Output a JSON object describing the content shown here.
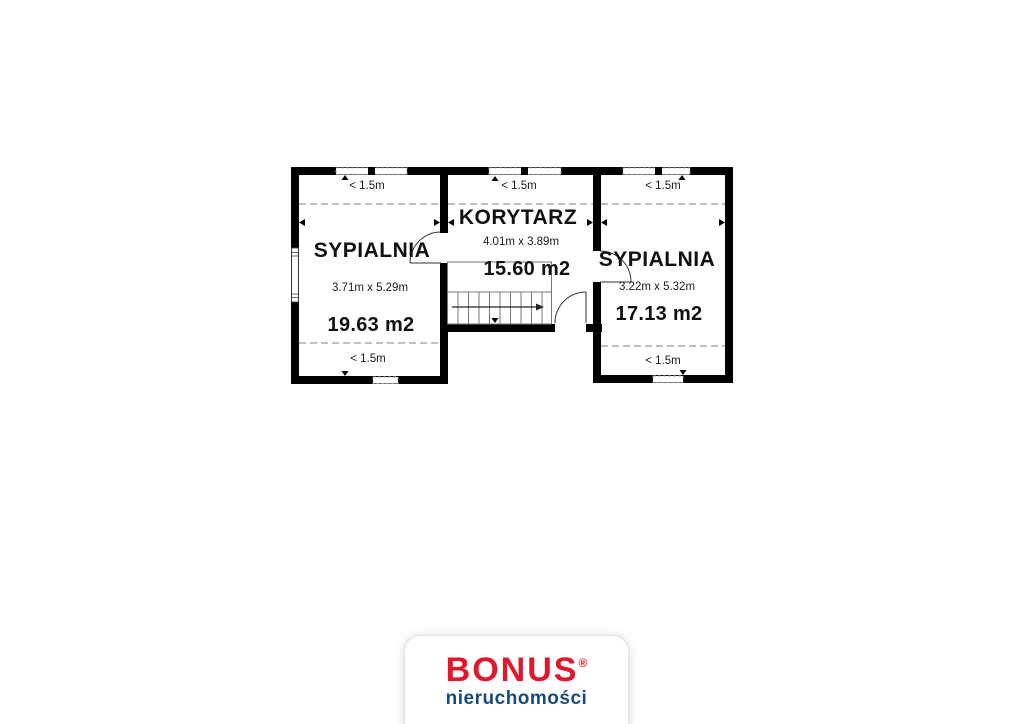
{
  "page": {
    "background": "#ffffff"
  },
  "floorplan": {
    "rooms": [
      {
        "id": "bedroom-left",
        "name": "SYPIALNIA",
        "dimensions": "3.71m x 5.29m",
        "area": "19.63 m2",
        "low_ceiling_top": "< 1.5m",
        "low_ceiling_bottom": "< 1.5m"
      },
      {
        "id": "corridor",
        "name": "KORYTARZ",
        "dimensions": "4.01m x 3.89m",
        "area": "15.60 m2",
        "low_ceiling_top": "< 1.5m"
      },
      {
        "id": "bedroom-right",
        "name": "SYPIALNIA",
        "dimensions": "3.22m x 5.32m",
        "area": "17.13 m2",
        "low_ceiling_top": "< 1.5m",
        "low_ceiling_bottom": "< 1.5m"
      }
    ],
    "icons": {
      "window": "window-icon",
      "door": "door-arc-icon",
      "stairs": "stairs-icon",
      "direction_arrow": "stairs-direction-arrow-icon"
    },
    "colors": {
      "wall": "#000000",
      "dashed_zone_line": "#9a9a9a"
    }
  },
  "logo": {
    "brand": "BONUS",
    "registered_mark": "®",
    "tagline": "nieruchomości",
    "brand_color": "#e0182d",
    "tagline_color": "#1a4b77"
  }
}
